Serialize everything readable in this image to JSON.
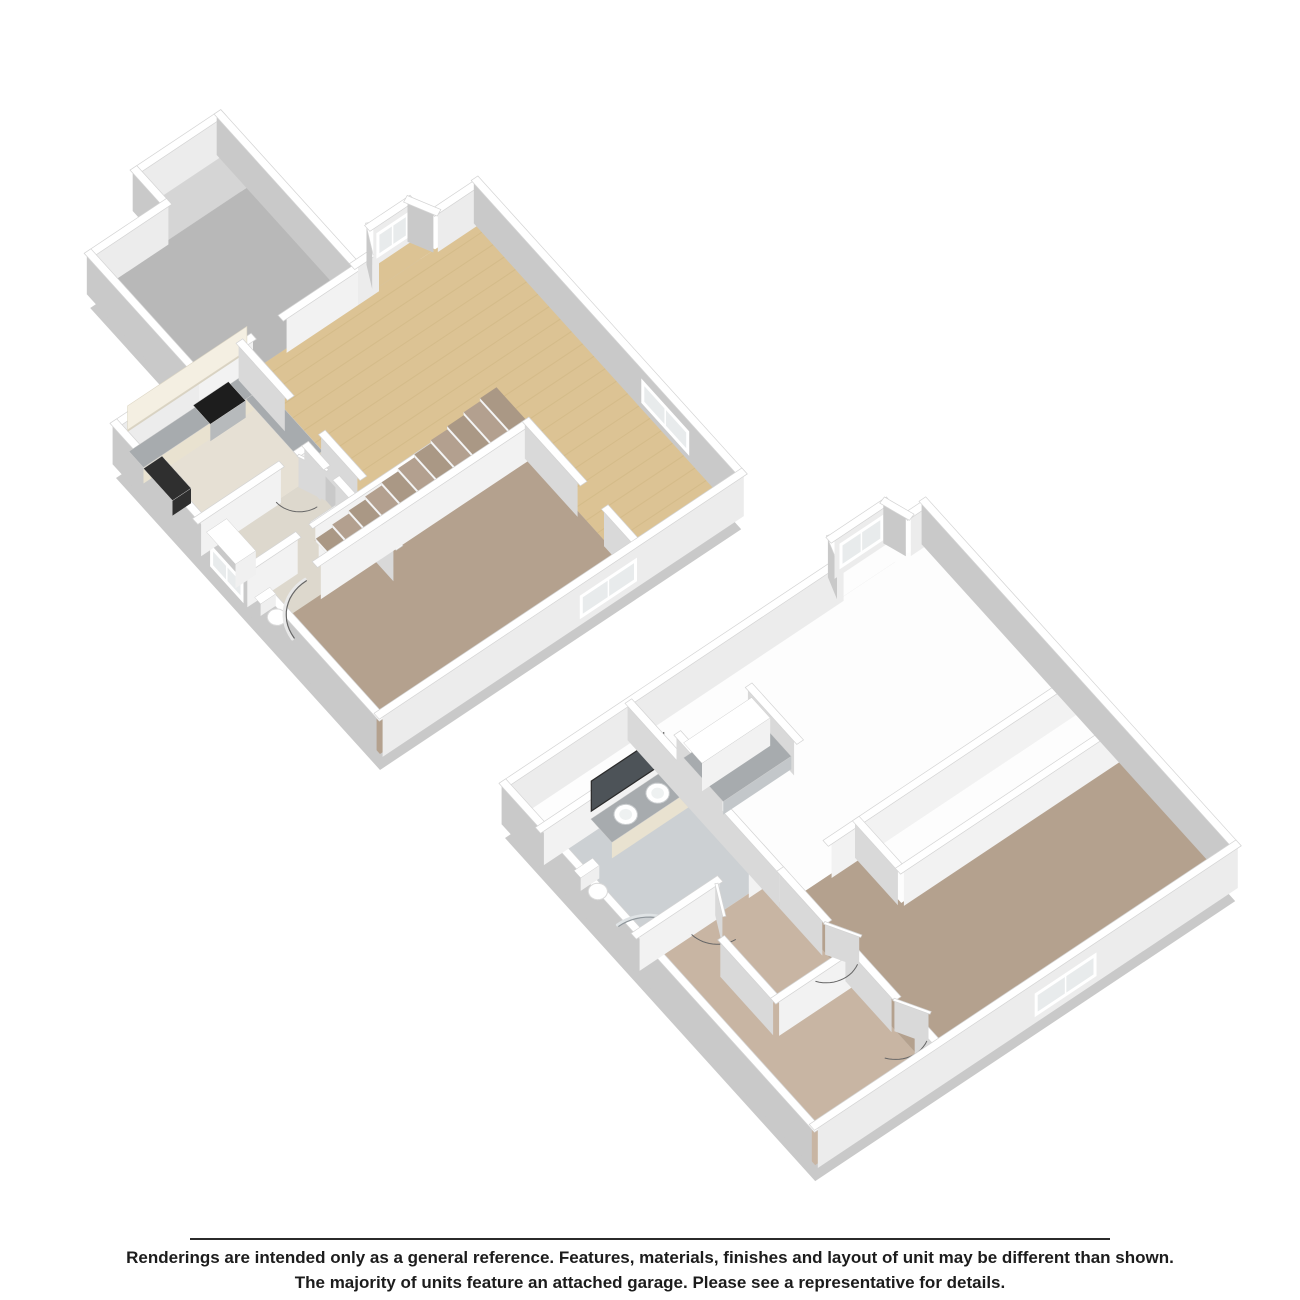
{
  "page": {
    "background": "#ffffff"
  },
  "footer": {
    "line1": "Renderings are intended only as a general reference. Features, materials, finishes and layout of unit may be different than shown.",
    "line2": "The majority of units feature an attached garage. Please see a representative for details."
  },
  "colors": {
    "background": "#ffffff",
    "slab": "#c9c9c9",
    "wall_top": "#ffffff",
    "wall_top_edge": "#d4d4d4",
    "face_a_int": "#f2f2f2",
    "face_a_ext": "#ececec",
    "face_b_int": "#d9d9d9",
    "face_b_ext": "#c9c9c9",
    "wood": "#dcc394",
    "wood_streak": "#c9ae79",
    "carpet": "#b4a18e",
    "carpet_light": "#c8b5a3",
    "entry_floor": "#b8b8b8",
    "closet_floor": "#d5d5d5",
    "kitchen_floor": "#e6e0d4",
    "hall_floor": "#ddd8cd",
    "tile": "#ccd0d3",
    "granite": "#a7abae",
    "granite_light": "#c3c7ca",
    "cabinet": "#e9e2d0",
    "cabinet_light": "#f4efe2",
    "cabinet_shadow": "#d8d2c2",
    "steel": "#b7babc",
    "cooktop": "#1d1d1d",
    "appliance_dark": "#2f2f2f",
    "mirror": "#4d5358",
    "frame_dark": "#2b2b2b",
    "fixture": "#ffffff",
    "fixture_edge": "#d9d9d9",
    "window_glass": "#e8ebec",
    "white_floor": "#fdfdfd",
    "arc_stroke": "#666666",
    "riser": "#f4f4f4",
    "tread_a": "#b3a08f",
    "tread_b": "#aa9885",
    "text": "#1c1c1c",
    "divider": "#2b2b2b"
  }
}
